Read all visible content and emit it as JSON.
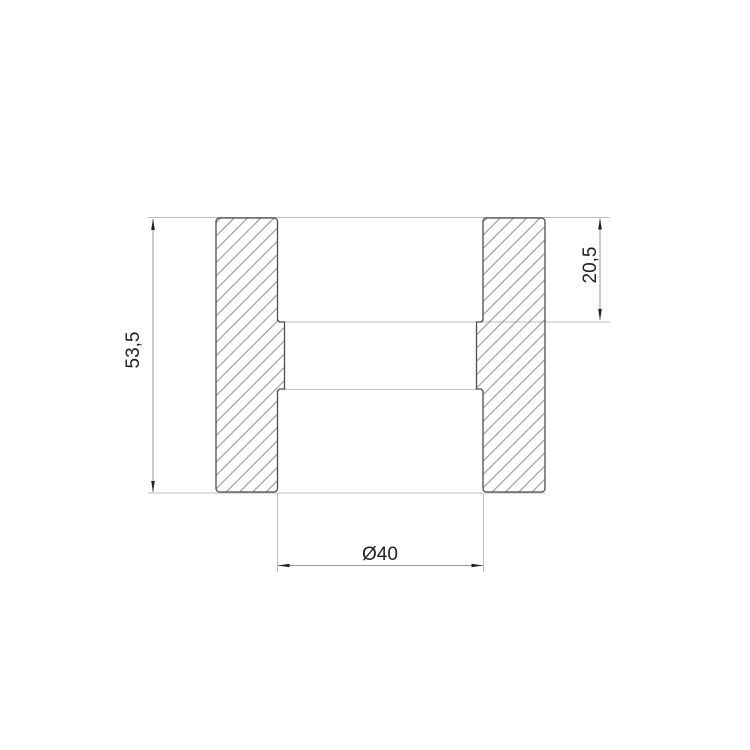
{
  "drawing": {
    "kind": "section-view-coupling",
    "dimensions": {
      "overall_height": {
        "label": "53,5",
        "value": 53.5
      },
      "socket_depth": {
        "label": "20,5",
        "value": 20.5
      },
      "bore_diameter": {
        "label": "Ø40",
        "value": 40
      }
    },
    "colors": {
      "background": "#ffffff",
      "outline": "#4d4d4d",
      "hatch": "#8f8f8f",
      "extension_line": "#bcbcbc",
      "dimension_line": "#979797",
      "text": "#222222"
    }
  }
}
